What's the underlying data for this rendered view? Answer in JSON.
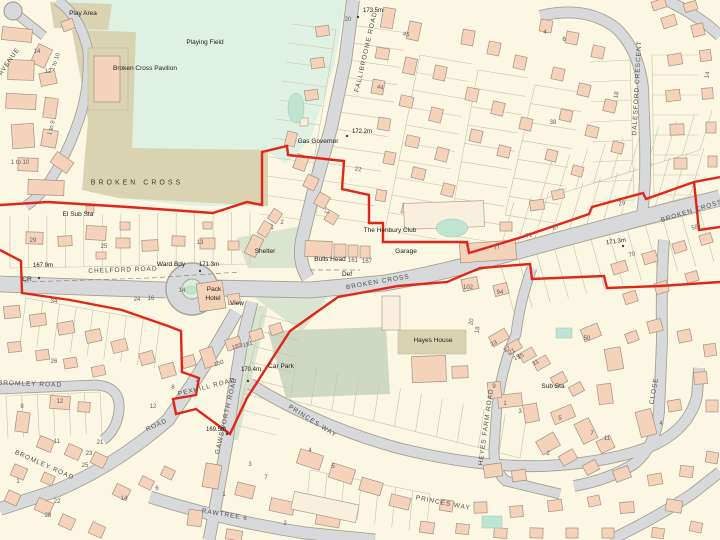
{
  "map": {
    "area_name": "BROKEN CROSS",
    "colors": {
      "background": "#FBF7E3",
      "road_fill": "#D8D9DB",
      "road_casing": "#A5A396",
      "building": "#F5D3BA",
      "building_outline": "#A8917F",
      "pale_building": "#F8EFDC",
      "field_green": "#DEF1E2",
      "verge_green": "#DAE4CE",
      "khaki": "#D9D3B2",
      "teal": "#BFE4D2",
      "boundary_red": "#E2251B",
      "parcel_line": "#C8C1A8"
    },
    "labels": [
      {
        "t": "CHELFORD ROAD",
        "x": 123,
        "y": 271,
        "r": -2,
        "c": "rn",
        "n": "road-label-chelford-road"
      },
      {
        "t": "BROKEN CROSS",
        "x": 378,
        "y": 283,
        "r": -10,
        "c": "rn",
        "n": "road-label-broken-cross-west"
      },
      {
        "t": "BROKEN CROSS",
        "x": 692,
        "y": 212,
        "r": -17,
        "c": "rn",
        "n": "road-label-broken-cross-east"
      },
      {
        "t": "FALLIBROOME ROAD",
        "x": 367,
        "y": 52,
        "r": -77,
        "c": "rn",
        "n": "road-label-fallibroome-road"
      },
      {
        "t": "DALESFORD CRESCENT",
        "x": 638,
        "y": 88,
        "r": -87,
        "c": "rn",
        "n": "road-label-dalesford-crescent"
      },
      {
        "t": "GAWSWORTH ROAD",
        "x": 227,
        "y": 416,
        "r": -77,
        "c": "rn",
        "n": "road-label-gawsworth-road"
      },
      {
        "t": "PEXHILL ROAD",
        "x": 207,
        "y": 388,
        "r": -14,
        "c": "rn",
        "n": "road-label-pexhill-road"
      },
      {
        "t": "ROAD",
        "x": 157,
        "y": 426,
        "r": -24,
        "c": "rn",
        "n": "road-label-road"
      },
      {
        "t": "BROMLEY ROAD",
        "x": 30,
        "y": 385,
        "r": 2,
        "c": "rn",
        "n": "road-label-bromley-road-1"
      },
      {
        "t": "BROMLEY ROAD",
        "x": 44,
        "y": 466,
        "r": 24,
        "c": "rn",
        "n": "road-label-bromley-road-2"
      },
      {
        "t": "PRINCES WAY",
        "x": 312,
        "y": 422,
        "r": 32,
        "c": "rn",
        "n": "road-label-princes-way-1"
      },
      {
        "t": "PRINCES WAY",
        "x": 443,
        "y": 504,
        "r": 11,
        "c": "rn",
        "n": "road-label-princes-way-2"
      },
      {
        "t": "RAWTREE",
        "x": 221,
        "y": 515,
        "r": 9,
        "c": "rn",
        "n": "road-label-rawtree"
      },
      {
        "t": "HEYES FARM ROAD",
        "x": 487,
        "y": 427,
        "r": -82,
        "c": "rn",
        "n": "road-label-heyes-farm-road"
      },
      {
        "t": "CLOSE",
        "x": 655,
        "y": 391,
        "r": -80,
        "c": "rn",
        "n": "road-label-close"
      },
      {
        "t": "AVENUE",
        "x": 10,
        "y": 62,
        "r": -55,
        "c": "rn",
        "n": "road-label-avenue"
      },
      {
        "t": "Play Area",
        "x": 83,
        "y": 14,
        "c": "pl",
        "n": "place-label-play-area"
      },
      {
        "t": "Playing Field",
        "x": 205,
        "y": 43,
        "c": "pl",
        "n": "place-label-playing-field"
      },
      {
        "t": "Broken Cross Pavilion",
        "x": 145,
        "y": 69,
        "c": "pl",
        "n": "place-label-pavilion"
      },
      {
        "t": "BROKEN CROSS",
        "x": 137,
        "y": 183,
        "c": "ar",
        "n": "place-label-broken-cross"
      },
      {
        "t": "El Sub Sta",
        "x": 78,
        "y": 215,
        "c": "pl",
        "n": "place-label-el-sub-sta"
      },
      {
        "t": "Gas Governor",
        "x": 318,
        "y": 142,
        "c": "pl",
        "n": "place-label-gas-governor"
      },
      {
        "t": "The Henbury Club",
        "x": 390,
        "y": 231,
        "c": "pl",
        "n": "place-label-henbury-club"
      },
      {
        "t": "Garage",
        "x": 406,
        "y": 252,
        "c": "pl",
        "n": "place-label-garage"
      },
      {
        "t": "Bulls Head",
        "x": 330,
        "y": 260,
        "c": "pl",
        "n": "place-label-bulls-head"
      },
      {
        "t": "Shelter",
        "x": 265,
        "y": 252,
        "c": "pl",
        "n": "place-label-shelter"
      },
      {
        "t": "Pack",
        "x": 214,
        "y": 290,
        "c": "pl",
        "n": "place-label-pack"
      },
      {
        "t": "Hotel",
        "x": 213,
        "y": 299,
        "c": "pl",
        "n": "place-label-hotel"
      },
      {
        "t": "View",
        "x": 237,
        "y": 304,
        "c": "pl",
        "n": "place-label-view"
      },
      {
        "t": "Car Park",
        "x": 281,
        "y": 367,
        "c": "pl",
        "n": "place-label-car-park"
      },
      {
        "t": "Hayes House",
        "x": 433,
        "y": 341,
        "c": "pl",
        "n": "place-label-hayes-house"
      },
      {
        "t": "Sub Sta",
        "x": 553,
        "y": 387,
        "c": "pl",
        "n": "place-label-sub-sta"
      },
      {
        "t": "Ward Bdy",
        "x": 171,
        "y": 265,
        "c": "pl",
        "n": "boundary-label-ward-bdy"
      },
      {
        "t": "CR",
        "x": 27,
        "y": 280,
        "c": "pl",
        "n": "boundary-label-cr"
      },
      {
        "t": "Def",
        "x": 347,
        "y": 275,
        "c": "pl",
        "n": "boundary-label-def"
      },
      {
        "t": "173.5m",
        "x": 373,
        "y": 11,
        "c": "ht",
        "n": "spot-height"
      },
      {
        "t": "172.2m",
        "x": 362,
        "y": 132,
        "c": "ht",
        "n": "spot-height"
      },
      {
        "t": "171.3m",
        "x": 209,
        "y": 265,
        "c": "ht",
        "n": "spot-height"
      },
      {
        "t": "171.3m",
        "x": 616,
        "y": 242,
        "r": -8,
        "c": "ht",
        "n": "spot-height"
      },
      {
        "t": "167.9m",
        "x": 43,
        "y": 266,
        "c": "ht",
        "n": "spot-height"
      },
      {
        "t": "170.4m",
        "x": 251,
        "y": 370,
        "c": "ht",
        "n": "spot-height"
      },
      {
        "t": "169.5m",
        "x": 216,
        "y": 430,
        "c": "ht",
        "n": "spot-height"
      },
      {
        "t": "14",
        "x": 37,
        "y": 52,
        "c": "nm",
        "n": "house-number"
      },
      {
        "t": "12",
        "x": 48,
        "y": 72,
        "c": "nm",
        "n": "house-number"
      },
      {
        "t": "1 to 10",
        "x": 56,
        "y": 62,
        "r": -70,
        "c": "nm",
        "n": "house-number"
      },
      {
        "t": "1 to 9",
        "x": 52,
        "y": 128,
        "r": -75,
        "c": "nm",
        "n": "house-number"
      },
      {
        "t": "1 to 10",
        "x": 20,
        "y": 163,
        "c": "nm",
        "n": "house-number"
      },
      {
        "t": "29",
        "x": 33,
        "y": 241,
        "c": "nm",
        "n": "house-number"
      },
      {
        "t": "25",
        "x": 104,
        "y": 247,
        "c": "nm",
        "n": "house-number"
      },
      {
        "t": "13",
        "x": 200,
        "y": 243,
        "c": "nm",
        "n": "house-number"
      },
      {
        "t": "34",
        "x": 54,
        "y": 302,
        "c": "nm",
        "n": "house-number"
      },
      {
        "t": "24",
        "x": 137,
        "y": 300,
        "c": "nm",
        "n": "house-number"
      },
      {
        "t": "16",
        "x": 151,
        "y": 299,
        "c": "nm",
        "n": "house-number"
      },
      {
        "t": "14",
        "x": 182,
        "y": 291,
        "c": "nm",
        "n": "house-number"
      },
      {
        "t": "1",
        "x": 272,
        "y": 228,
        "c": "nm",
        "n": "house-number"
      },
      {
        "t": "2",
        "x": 282,
        "y": 223,
        "c": "nm",
        "n": "house-number"
      },
      {
        "t": "17",
        "x": 328,
        "y": 211,
        "r": -75,
        "c": "nm",
        "n": "house-number"
      },
      {
        "t": "161",
        "x": 353,
        "y": 261,
        "c": "nm",
        "n": "house-number"
      },
      {
        "t": "167",
        "x": 367,
        "y": 262,
        "c": "nm",
        "n": "house-number"
      },
      {
        "t": "102",
        "x": 468,
        "y": 288,
        "c": "nm",
        "n": "house-number"
      },
      {
        "t": "94",
        "x": 500,
        "y": 293,
        "c": "nm",
        "n": "house-number"
      },
      {
        "t": "77",
        "x": 497,
        "y": 248,
        "r": -15,
        "c": "nm",
        "n": "house-number"
      },
      {
        "t": "71",
        "x": 529,
        "y": 236,
        "r": -15,
        "c": "nm",
        "n": "house-number"
      },
      {
        "t": "87",
        "x": 556,
        "y": 228,
        "r": -15,
        "c": "nm",
        "n": "house-number"
      },
      {
        "t": "70",
        "x": 632,
        "y": 255,
        "r": -15,
        "c": "nm",
        "n": "house-number"
      },
      {
        "t": "58",
        "x": 695,
        "y": 228,
        "r": -15,
        "c": "nm",
        "n": "house-number"
      },
      {
        "t": "29",
        "x": 622,
        "y": 204,
        "r": -15,
        "c": "nm",
        "n": "house-number"
      },
      {
        "t": "20",
        "x": 348,
        "y": 20,
        "c": "nm",
        "n": "house-number"
      },
      {
        "t": "45",
        "x": 406,
        "y": 35,
        "r": 12,
        "c": "nm",
        "n": "house-number"
      },
      {
        "t": "44",
        "x": 380,
        "y": 88,
        "r": 12,
        "c": "nm",
        "n": "house-number"
      },
      {
        "t": "22",
        "x": 358,
        "y": 170,
        "r": 10,
        "c": "nm",
        "n": "house-number"
      },
      {
        "t": "4",
        "x": 545,
        "y": 33,
        "c": "nm",
        "n": "house-number"
      },
      {
        "t": "6",
        "x": 564,
        "y": 40,
        "c": "nm",
        "n": "house-number"
      },
      {
        "t": "18",
        "x": 617,
        "y": 95,
        "r": -80,
        "c": "nm",
        "n": "house-number"
      },
      {
        "t": "38",
        "x": 553,
        "y": 123,
        "c": "nm",
        "n": "house-number"
      },
      {
        "t": "14",
        "x": 708,
        "y": 75,
        "r": -80,
        "c": "nm",
        "n": "house-number"
      },
      {
        "t": "183",
        "x": 237,
        "y": 347,
        "r": -18,
        "c": "nm",
        "n": "house-number"
      },
      {
        "t": "181",
        "x": 248,
        "y": 345,
        "r": -18,
        "c": "nm",
        "n": "house-number"
      },
      {
        "t": "150",
        "x": 219,
        "y": 364,
        "r": -18,
        "c": "nm",
        "n": "house-number"
      },
      {
        "t": "2",
        "x": 197,
        "y": 381,
        "c": "nm",
        "n": "house-number"
      },
      {
        "t": "8",
        "x": 173,
        "y": 388,
        "c": "nm",
        "n": "house-number"
      },
      {
        "t": "12",
        "x": 153,
        "y": 407,
        "c": "nm",
        "n": "house-number"
      },
      {
        "t": "26",
        "x": 54,
        "y": 362,
        "c": "nm",
        "n": "house-number"
      },
      {
        "t": "8",
        "x": 22,
        "y": 407,
        "c": "nm",
        "n": "house-number"
      },
      {
        "t": "12",
        "x": 60,
        "y": 402,
        "c": "nm",
        "n": "house-number"
      },
      {
        "t": "11",
        "x": 57,
        "y": 442,
        "c": "nm",
        "n": "house-number"
      },
      {
        "t": "21",
        "x": 100,
        "y": 443,
        "c": "nm",
        "n": "house-number"
      },
      {
        "t": "23",
        "x": 89,
        "y": 454,
        "c": "nm",
        "n": "house-number"
      },
      {
        "t": "25",
        "x": 85,
        "y": 466,
        "c": "nm",
        "n": "house-number"
      },
      {
        "t": "1",
        "x": 18,
        "y": 482,
        "c": "nm",
        "n": "house-number"
      },
      {
        "t": "22",
        "x": 57,
        "y": 502,
        "c": "nm",
        "n": "house-number"
      },
      {
        "t": "28",
        "x": 48,
        "y": 516,
        "c": "nm",
        "n": "house-number"
      },
      {
        "t": "14",
        "x": 124,
        "y": 499,
        "c": "nm",
        "n": "house-number"
      },
      {
        "t": "6",
        "x": 157,
        "y": 489,
        "c": "nm",
        "n": "house-number"
      },
      {
        "t": "1",
        "x": 224,
        "y": 495,
        "c": "nm",
        "n": "house-number"
      },
      {
        "t": "3",
        "x": 250,
        "y": 465,
        "c": "nm",
        "n": "house-number"
      },
      {
        "t": "7",
        "x": 266,
        "y": 478,
        "c": "nm",
        "n": "house-number"
      },
      {
        "t": "4",
        "x": 310,
        "y": 451,
        "c": "nm",
        "n": "house-number"
      },
      {
        "t": "5",
        "x": 333,
        "y": 467,
        "c": "nm",
        "n": "house-number"
      },
      {
        "t": "6",
        "x": 245,
        "y": 519,
        "c": "nm",
        "n": "house-number"
      },
      {
        "t": "2",
        "x": 285,
        "y": 524,
        "c": "nm",
        "n": "house-number"
      },
      {
        "t": "23",
        "x": 494,
        "y": 344,
        "r": -28,
        "c": "nm",
        "n": "house-number"
      },
      {
        "t": "17",
        "x": 507,
        "y": 350,
        "r": -28,
        "c": "nm",
        "n": "house-number"
      },
      {
        "t": "15",
        "x": 521,
        "y": 357,
        "r": -28,
        "c": "nm",
        "n": "house-number"
      },
      {
        "t": "11",
        "x": 536,
        "y": 363,
        "r": -28,
        "c": "nm",
        "n": "house-number"
      },
      {
        "t": "50",
        "x": 587,
        "y": 339,
        "c": "nm",
        "n": "house-number"
      },
      {
        "t": "20",
        "x": 472,
        "y": 322,
        "r": -80,
        "c": "nm",
        "n": "house-number"
      },
      {
        "t": "18",
        "x": 478,
        "y": 330,
        "r": -80,
        "c": "nm",
        "n": "house-number"
      },
      {
        "t": "21",
        "x": 512,
        "y": 352,
        "r": -28,
        "c": "nm",
        "n": "house-number"
      },
      {
        "t": "19",
        "x": 517,
        "y": 358,
        "r": -28,
        "c": "nm",
        "n": "house-number"
      },
      {
        "t": "9",
        "x": 494,
        "y": 387,
        "c": "nm",
        "n": "house-number"
      },
      {
        "t": "1",
        "x": 505,
        "y": 404,
        "c": "nm",
        "n": "house-number"
      },
      {
        "t": "3",
        "x": 520,
        "y": 412,
        "c": "nm",
        "n": "house-number"
      },
      {
        "t": "5",
        "x": 560,
        "y": 419,
        "c": "nm",
        "n": "house-number"
      },
      {
        "t": "7",
        "x": 592,
        "y": 434,
        "c": "nm",
        "n": "house-number"
      },
      {
        "t": "11",
        "x": 607,
        "y": 439,
        "c": "nm",
        "n": "house-number"
      },
      {
        "t": "4",
        "x": 661,
        "y": 424,
        "c": "nm",
        "n": "house-number"
      },
      {
        "t": "2",
        "x": 548,
        "y": 454,
        "c": "nm",
        "n": "house-number"
      }
    ]
  }
}
